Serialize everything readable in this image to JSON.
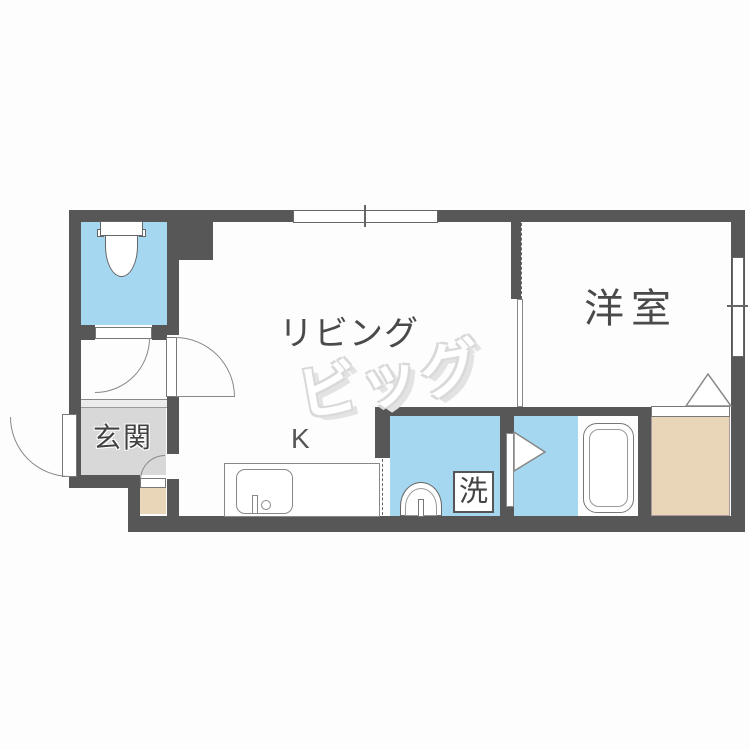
{
  "plan_title": "1DK apartment floor plan",
  "rooms": {
    "living": "リビング",
    "western": "洋室",
    "entrance": "玄関",
    "kitchen": "K",
    "laundry": "洗"
  },
  "watermark": "ビッグ",
  "colors": {
    "wall": "#575757",
    "water_blue": "#a5d8f0",
    "entrance_gray": "#d8d8d8",
    "closet_tan": "#e9d6b8",
    "label_gray": "#4a4a4a"
  }
}
